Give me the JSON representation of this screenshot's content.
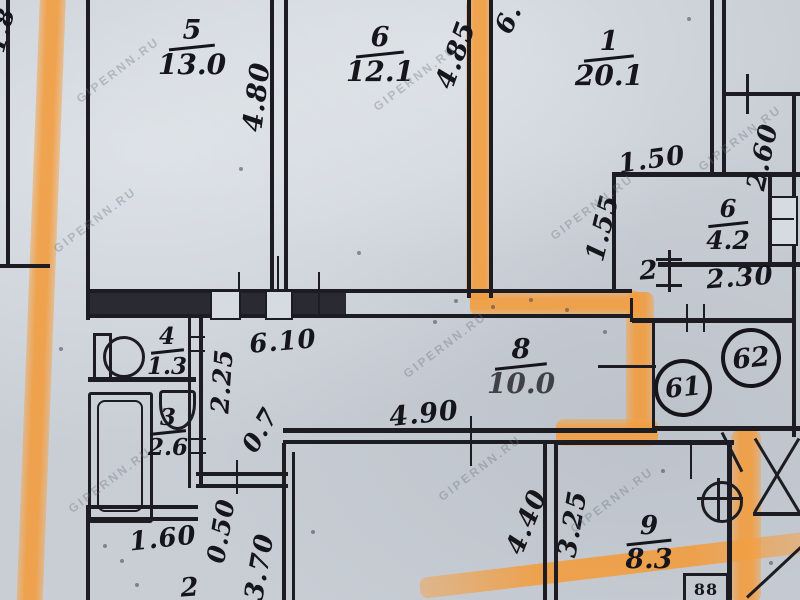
{
  "watermark": {
    "text": "GIPERNN.RU"
  },
  "apartments": [
    {
      "number": "61"
    },
    {
      "number": "62"
    }
  ],
  "rooms": [
    {
      "num": "5",
      "area": "13.0"
    },
    {
      "num": "6",
      "area": "12.1"
    },
    {
      "num": "1",
      "area": "20.1"
    },
    {
      "num": "6",
      "area": "4.2"
    },
    {
      "num": "8",
      "area": "10.0"
    },
    {
      "num": "9",
      "area": "8.3"
    },
    {
      "num": "4",
      "area": "1.3"
    },
    {
      "num": "3",
      "area": "2.6"
    }
  ],
  "extra_room_labels": [
    {
      "text": "2"
    },
    {
      "text": "2"
    }
  ],
  "dimensions": [
    {
      "text": "4.80"
    },
    {
      "text": "4.85"
    },
    {
      "text": "6."
    },
    {
      "text": "1.50"
    },
    {
      "text": "1.55"
    },
    {
      "text": "2.60"
    },
    {
      "text": "2.30"
    },
    {
      "text": "6.10"
    },
    {
      "text": "2.25"
    },
    {
      "text": "0.7"
    },
    {
      "text": "4.90"
    },
    {
      "text": "4.40"
    },
    {
      "text": "3.25"
    },
    {
      "text": "1.60"
    },
    {
      "text": "0.50"
    },
    {
      "text": "3.70"
    },
    {
      "text": "1.8"
    }
  ],
  "fixtures": {
    "stove_label": "88"
  },
  "colors": {
    "highlighter": "#f2a155",
    "paper": "#c9ced5",
    "ink": "#1c1c22"
  }
}
